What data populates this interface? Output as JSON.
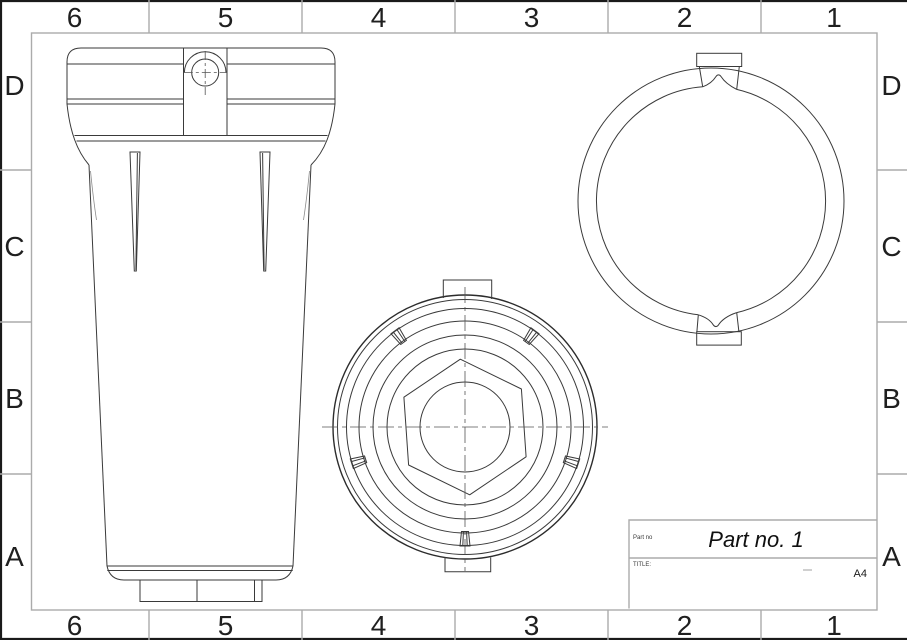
{
  "sheet": {
    "type": "engineering-drawing-sheet",
    "paper_size": "A4"
  },
  "colors": {
    "background": "#ffffff",
    "drawing_line": "#3a3a3a",
    "outline_heavy": "#2c2c2c",
    "frame_gray": "#ababab",
    "edge_black": "#1a1a1a",
    "label_text": "#1f1f1f",
    "centerline": "#555555"
  },
  "grid": {
    "columns": [
      "6",
      "5",
      "4",
      "3",
      "2",
      "1"
    ],
    "rows": [
      "D",
      "C",
      "B",
      "A"
    ]
  },
  "title_block": {
    "part_no_label": "Part no",
    "part_no": "Part no. 1",
    "title_label": "TITLE:",
    "sheet_size": "A4"
  },
  "views": {
    "front_view": "filter housing front elevation",
    "bottom_view": "filter housing bottom view with hex nut",
    "top_view": "cover ring top view"
  }
}
